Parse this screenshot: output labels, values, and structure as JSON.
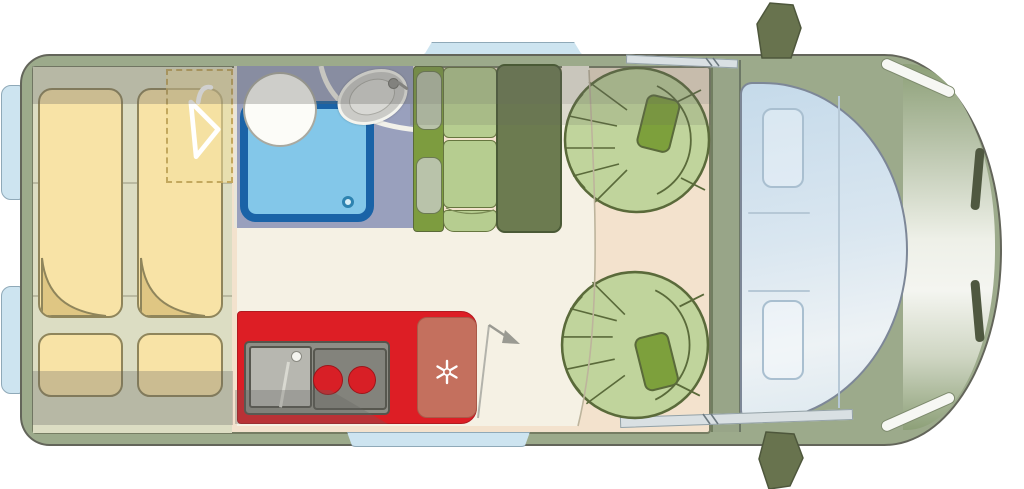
{
  "scene": {
    "type": "motorhome-floorplan",
    "view": "top-down",
    "vehicle": "campervan",
    "orientation": "front-right-rear-left"
  },
  "colors": {
    "body-olive": "#9caa8b",
    "floor-beige": "#f3e2cd",
    "walkway-white": "#f5f1e4",
    "bed-platform": "#dcddc3",
    "mattress-yellow": "#f8e3a6",
    "mattress-fold": "#dfc683",
    "bathroom-floor": "#99a0bd",
    "shower-blue-border": "#1a63a7",
    "shower-blue-fill": "#83c7e9",
    "kitchen-red": "#dd1e25",
    "fridge-salmon": "#c4705e",
    "burner-red": "#d81f26",
    "bench-green": "#b6cd90",
    "bench-backrest-green": "#7d9c3f",
    "table-olive": "#6c7b50",
    "seat-green": "#c0d49c",
    "seat-center-green": "#7da03c",
    "cab-glass-blue": "#d2e2ee",
    "window-blue": "#cde4f0",
    "mirror-olive": "#68734e"
  },
  "rooms": {
    "rear_bed": {
      "label": "transverse bed",
      "items": [
        "mattress-left",
        "mattress-right",
        "bed-cushion-left",
        "bed-cushion-right",
        "wardrobe"
      ]
    },
    "bathroom": {
      "label": "washroom",
      "items": [
        "shower-tray",
        "toilet",
        "washbasin",
        "faucet"
      ]
    },
    "kitchen": {
      "label": "kitchenette",
      "items": [
        "sink",
        "two-burner-hob",
        "fridge"
      ]
    },
    "dinette": {
      "label": "dinette",
      "items": [
        "bench-two-seats",
        "table",
        "swivel-seat-upper",
        "swivel-seat-lower"
      ]
    },
    "cab": {
      "label": "driver cab",
      "items": [
        "driver-seat-ghost",
        "passenger-seat-ghost",
        "windshield",
        "hood",
        "mirrors"
      ]
    }
  },
  "icons": [
    "hanger-icon",
    "snowflake-icon",
    "faucet-icon",
    "door-swing-arrow",
    "shower-drain-icon"
  ]
}
